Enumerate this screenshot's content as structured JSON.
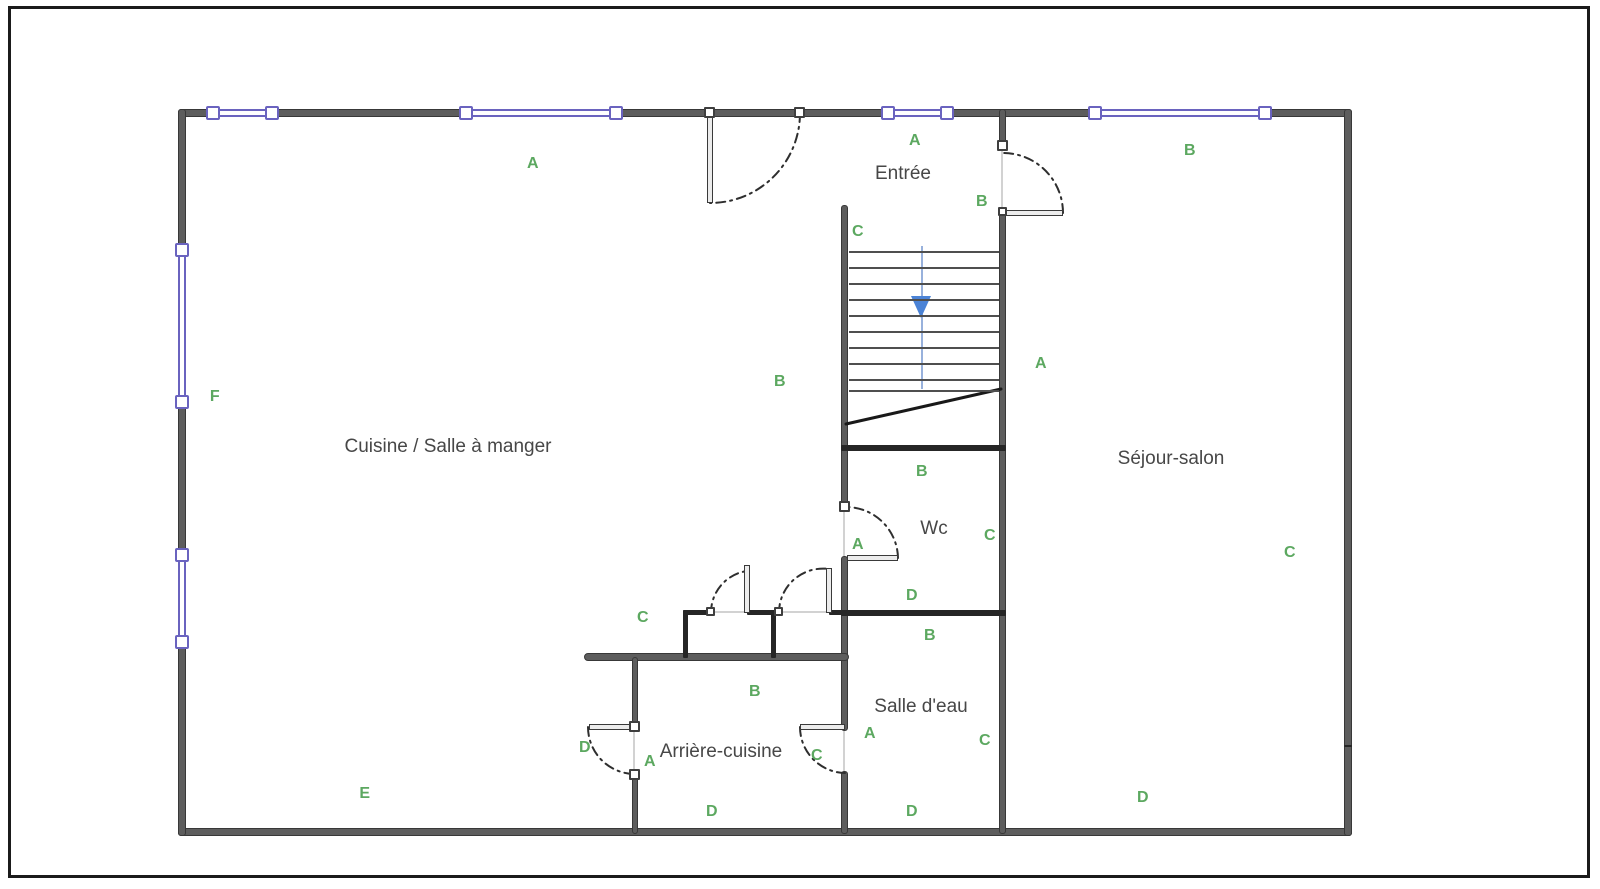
{
  "rooms": [
    {
      "label": "Cuisine / Salle à manger",
      "x": 448,
      "y": 447
    },
    {
      "label": "Séjour-salon",
      "x": 1171,
      "y": 459
    },
    {
      "label": "Entrée",
      "x": 903,
      "y": 174
    },
    {
      "label": "Wc",
      "x": 934,
      "y": 529
    },
    {
      "label": "Salle d'eau",
      "x": 921,
      "y": 707
    },
    {
      "label": "Arrière-cuisine",
      "x": 721,
      "y": 752
    }
  ],
  "markers": [
    {
      "label": "A",
      "x": 533,
      "y": 164
    },
    {
      "label": "A",
      "x": 915,
      "y": 141
    },
    {
      "label": "B",
      "x": 1190,
      "y": 151
    },
    {
      "label": "B",
      "x": 982,
      "y": 202
    },
    {
      "label": "C",
      "x": 858,
      "y": 232
    },
    {
      "label": "B",
      "x": 780,
      "y": 382
    },
    {
      "label": "A",
      "x": 1041,
      "y": 364
    },
    {
      "label": "F",
      "x": 215,
      "y": 397
    },
    {
      "label": "B",
      "x": 922,
      "y": 472
    },
    {
      "label": "C",
      "x": 990,
      "y": 536
    },
    {
      "label": "A",
      "x": 858,
      "y": 545
    },
    {
      "label": "D",
      "x": 912,
      "y": 596
    },
    {
      "label": "C",
      "x": 643,
      "y": 618
    },
    {
      "label": "B",
      "x": 930,
      "y": 636
    },
    {
      "label": "B",
      "x": 755,
      "y": 692
    },
    {
      "label": "A",
      "x": 870,
      "y": 734
    },
    {
      "label": "C",
      "x": 985,
      "y": 741
    },
    {
      "label": "C",
      "x": 817,
      "y": 756
    },
    {
      "label": "D",
      "x": 585,
      "y": 748
    },
    {
      "label": "A",
      "x": 650,
      "y": 762
    },
    {
      "label": "E",
      "x": 365,
      "y": 794
    },
    {
      "label": "D",
      "x": 712,
      "y": 812
    },
    {
      "label": "D",
      "x": 912,
      "y": 812
    },
    {
      "label": "D",
      "x": 1143,
      "y": 798
    },
    {
      "label": "C",
      "x": 1290,
      "y": 553
    }
  ],
  "stairs": {
    "x1": 849,
    "x2": 999,
    "treads_y": [
      251,
      267,
      283,
      299,
      315,
      331,
      347,
      363,
      379,
      390
    ],
    "arrow_direction": "down"
  },
  "colors": {
    "wall_fill": "#5d5d5d",
    "wall_edge": "#383838",
    "wall_dark": "#262626",
    "window": "#6a63bf",
    "green": "#5ca860",
    "room_text": "#474747",
    "arrow": "#4b83d6",
    "guide": "#98b1dc",
    "opening": "#d2d2d2",
    "frame": "#1b1b1b"
  }
}
